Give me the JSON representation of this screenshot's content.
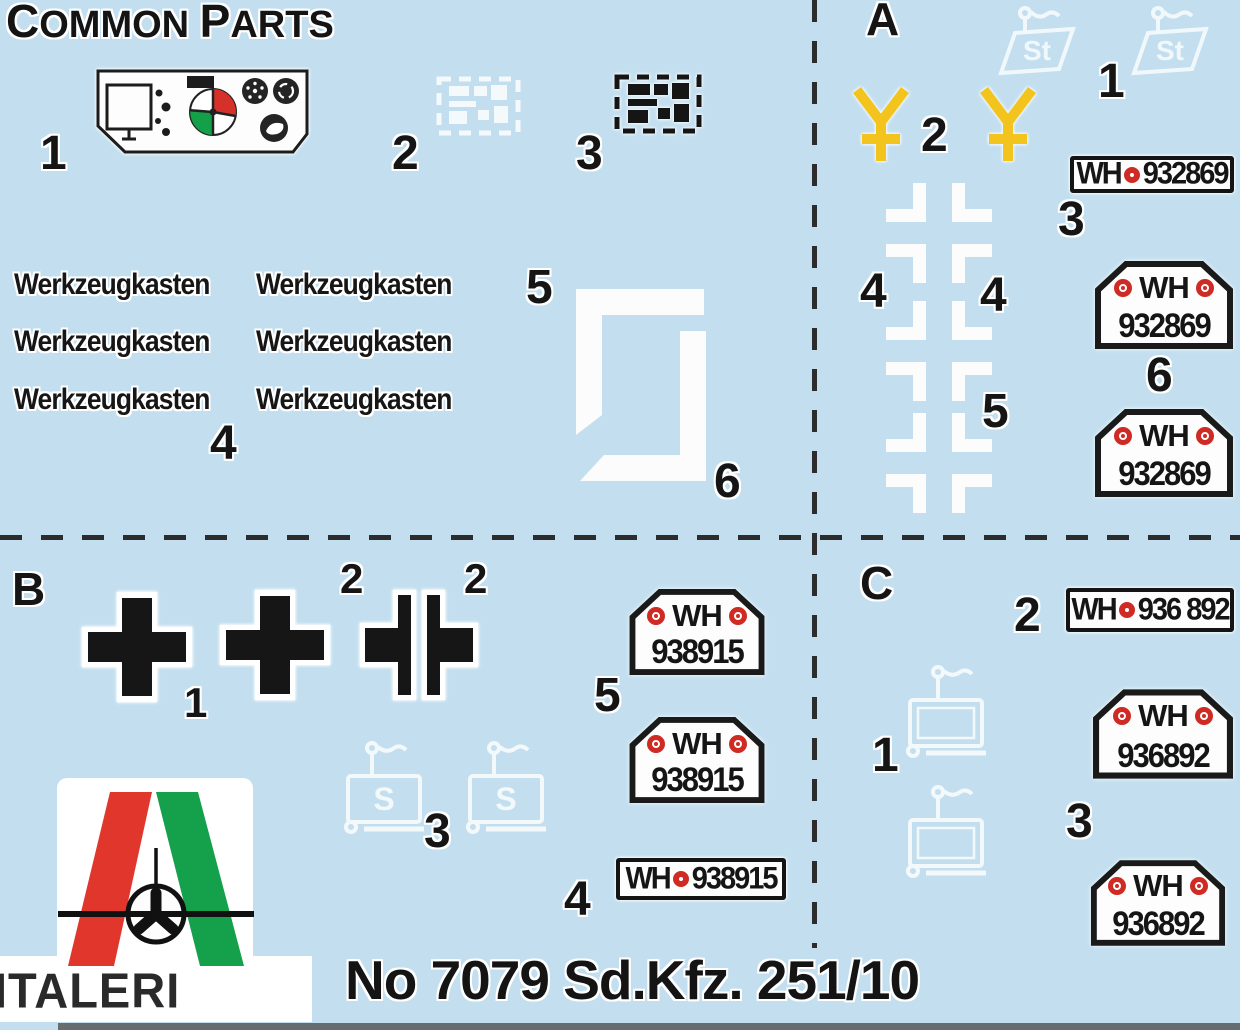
{
  "sheet": {
    "kind": "model-kit decal placement sheet",
    "colors": {
      "background": "#c3dfef",
      "black": "#1a1a1a",
      "white": "#ffffff",
      "yellow": "#f2c41d",
      "logo_red": "#e0362c",
      "logo_green": "#15a14c",
      "seal_red": "#cf2b24"
    }
  },
  "header": {
    "common_title": {
      "c": "C",
      "ommon": "OMMON",
      "p": "P",
      "arts": "ARTS"
    },
    "section_a": "A",
    "section_b": "B",
    "section_c": "C"
  },
  "labels": {
    "common": {
      "i1": "1",
      "i2": "2",
      "i3": "3",
      "i4": "4",
      "i5": "5",
      "i6": "6"
    },
    "a": {
      "i1": "1",
      "i2": "2",
      "i3": "3",
      "i4_left": "4",
      "i4_right": "4",
      "i5": "5",
      "i6": "6"
    },
    "b": {
      "i1": "1",
      "i2_a": "2",
      "i2_b": "2",
      "i3": "3",
      "i4": "4",
      "i5": "5"
    },
    "c": {
      "i1": "1",
      "i2": "2",
      "i3": "3"
    }
  },
  "decals": {
    "werkzeugkasten": "Werkzeugkasten",
    "st_marking": "St",
    "s_marking": "S",
    "plates": {
      "prefix": "WH",
      "a_number": "932869",
      "b_number": "938915",
      "c_number_rect": "936 892",
      "c_number_pent": "936892"
    }
  },
  "footer": {
    "brand": "ITALERI",
    "title": "No 7079 Sd.Kfz. 251/10"
  }
}
